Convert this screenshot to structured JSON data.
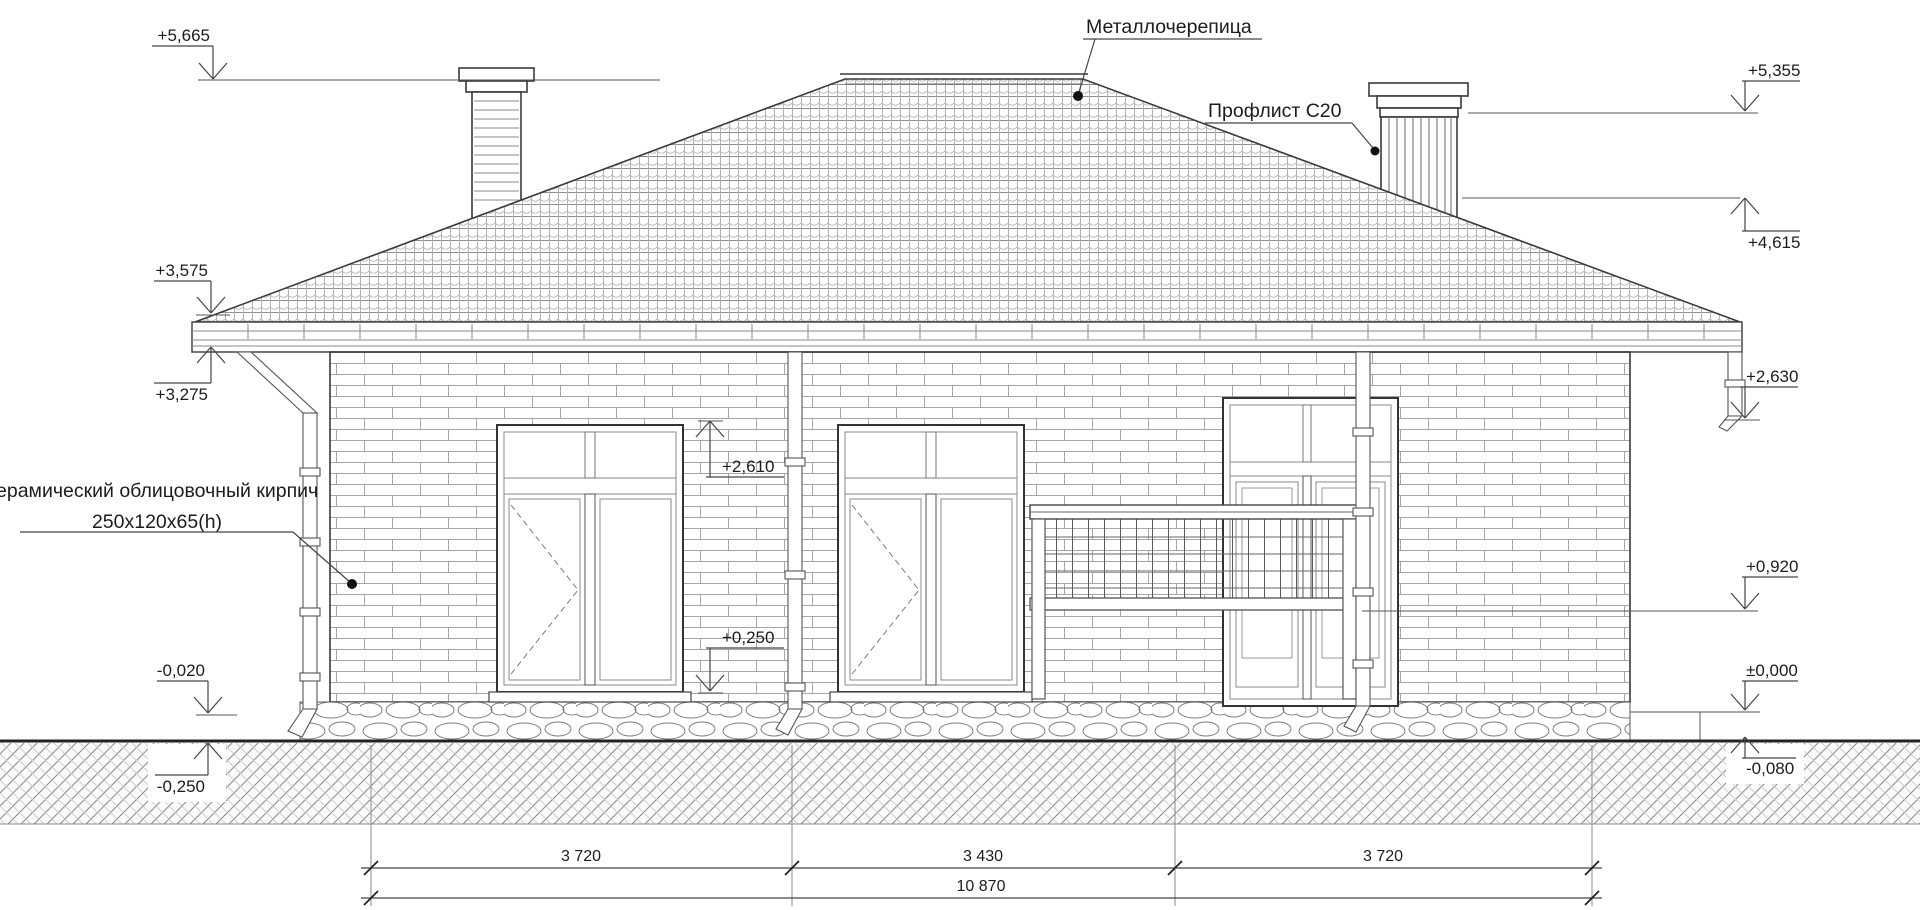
{
  "labels": {
    "roof_material": "Металлочерепица",
    "chimney_cladding": "Профлист С20",
    "brick_line1": "ерамический облицовочный кирпич",
    "brick_line2": "250х120х65(h)"
  },
  "marks": {
    "ridge": "+5,665",
    "chimney_top": "+5,355",
    "roof_at_chimney": "+4,615",
    "eaves_top": "+3,575",
    "eaves_bottom": "+3,275",
    "terrace_corner": "+2,630",
    "window_top": "+2,610",
    "railing_top": "+0,920",
    "window_sill": "+0,250",
    "zero_level": "±0,000",
    "ground_right": "-0,080",
    "plinth_left": "-0,020",
    "ground_left": "-0,250"
  },
  "dimensions": {
    "seg1": "3 720",
    "seg2": "3 430",
    "seg3": "3 720",
    "total": "10 870"
  }
}
